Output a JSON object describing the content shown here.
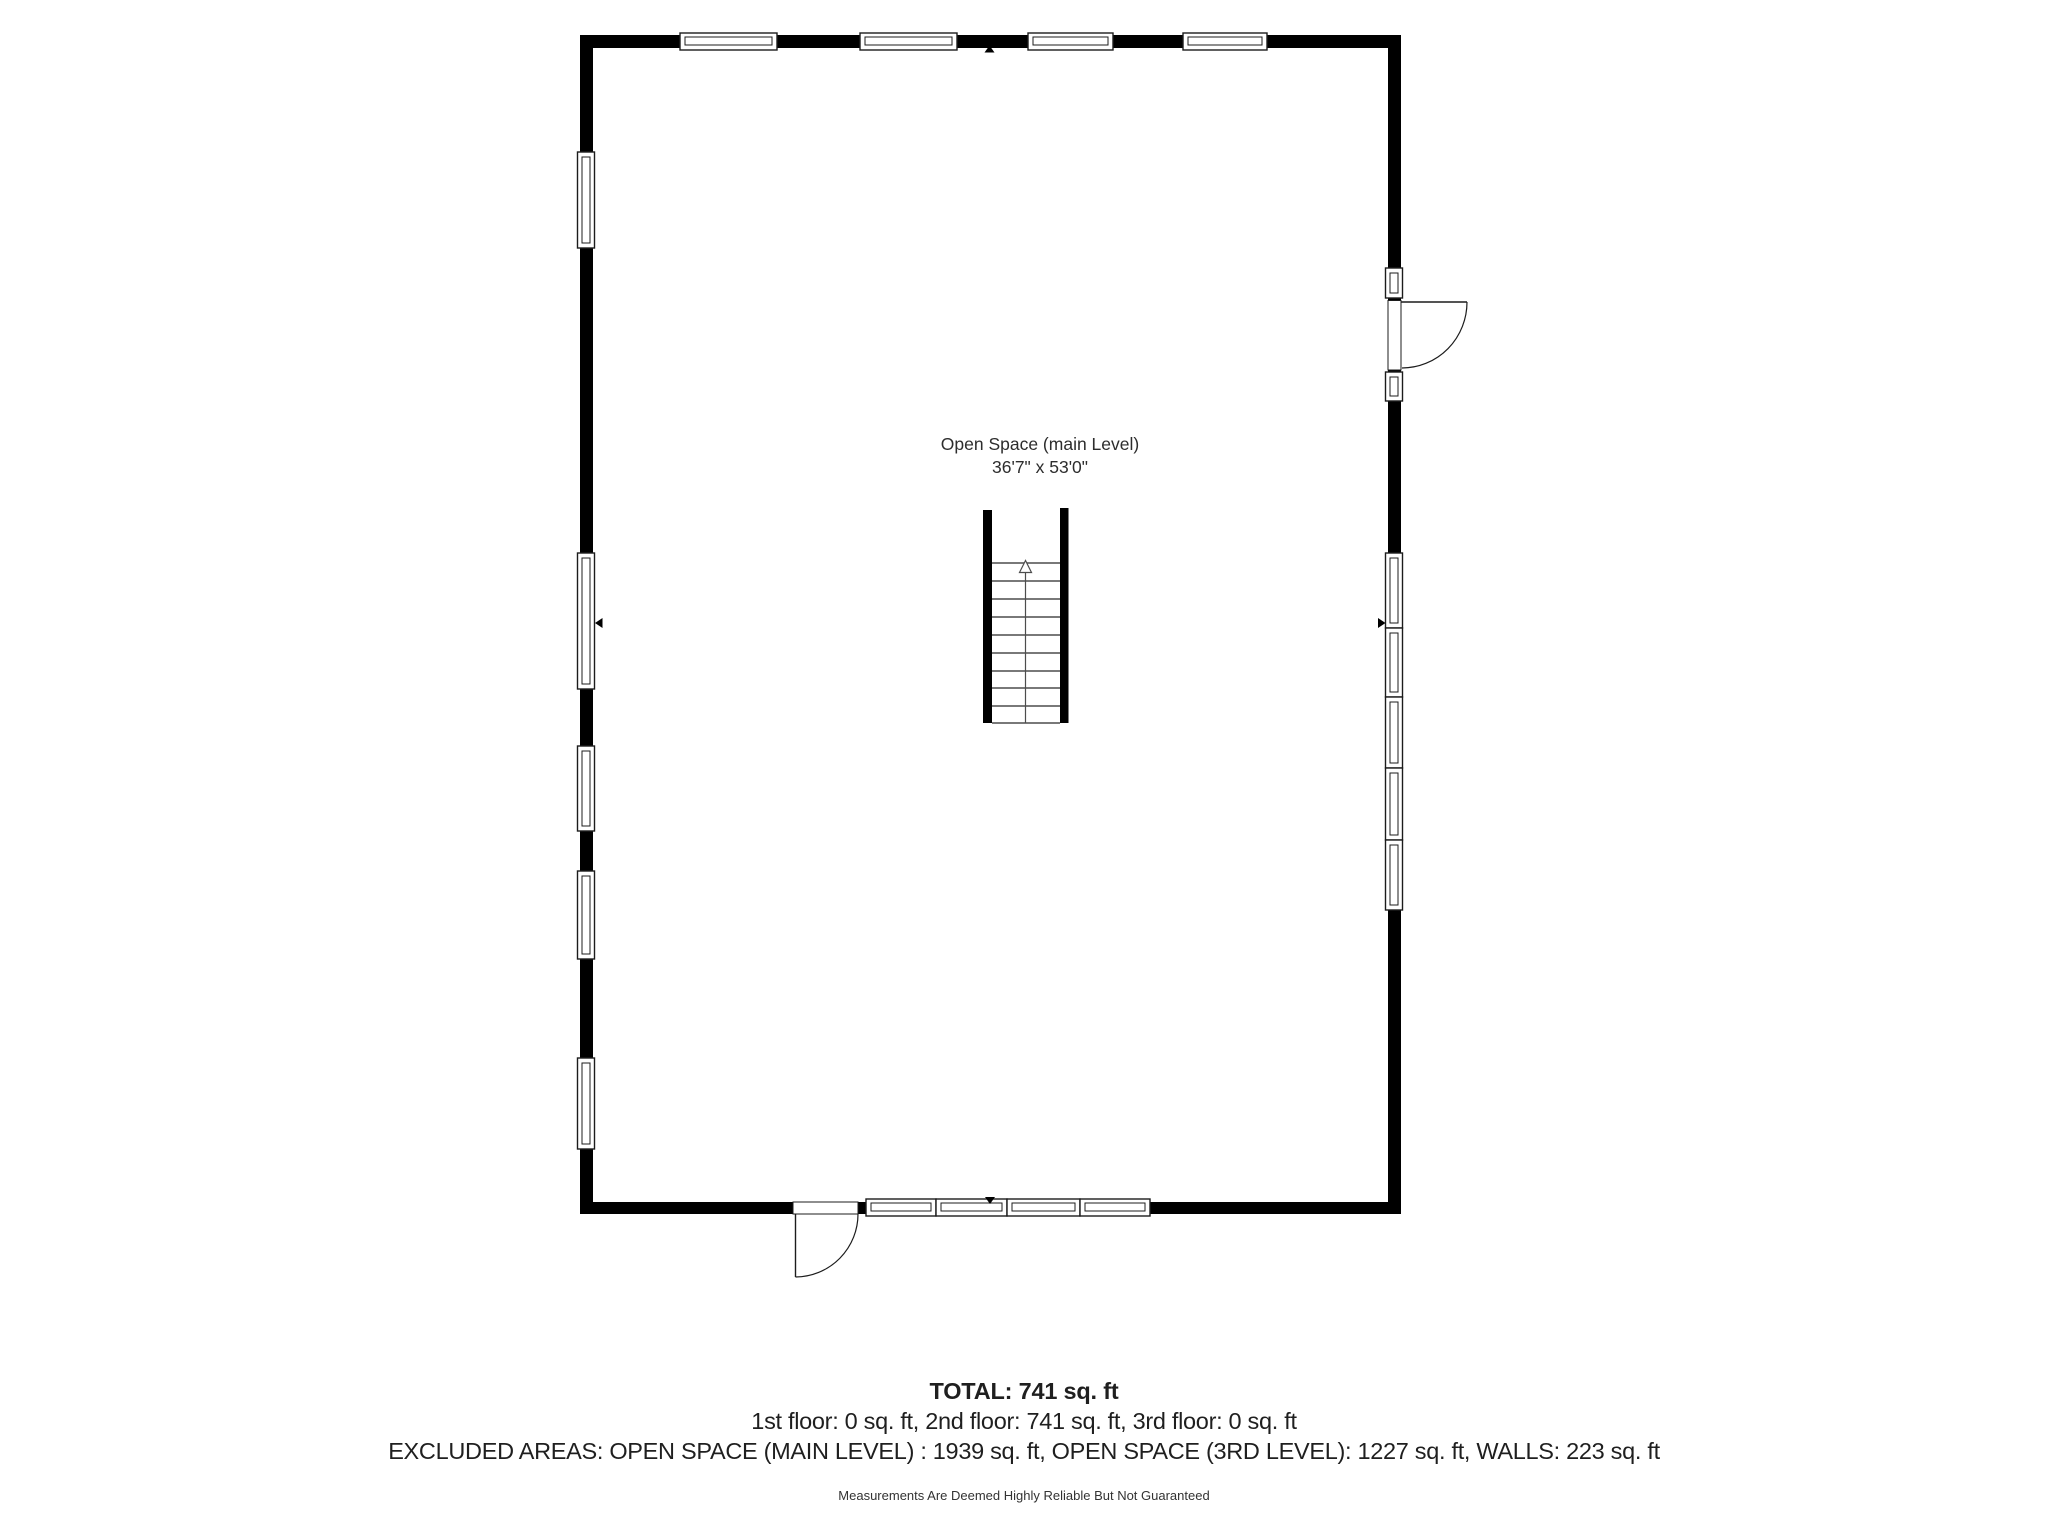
{
  "plan": {
    "room": {
      "label": "Open Space (main Level)",
      "dimensions": "36'7\" x 53'0\""
    },
    "stair_direction": "up"
  },
  "summary": {
    "total": "TOTAL: 741 sq. ft",
    "floor_breakdown": "1st floor: 0 sq. ft, 2nd floor: 741 sq. ft, 3rd floor: 0 sq. ft",
    "excluded_areas": "EXCLUDED AREAS: OPEN SPACE (MAIN LEVEL) : 1939 sq. ft, OPEN SPACE (3RD LEVEL): 1227 sq. ft, WALLS: 223 sq. ft",
    "disclaimer": "Measurements Are Deemed Highly Reliable But Not Guaranteed"
  },
  "colors": {
    "background": "#ffffff",
    "wall": "#000000",
    "text": "#2d2d2d",
    "stair_lines": "#4d4d4d"
  }
}
